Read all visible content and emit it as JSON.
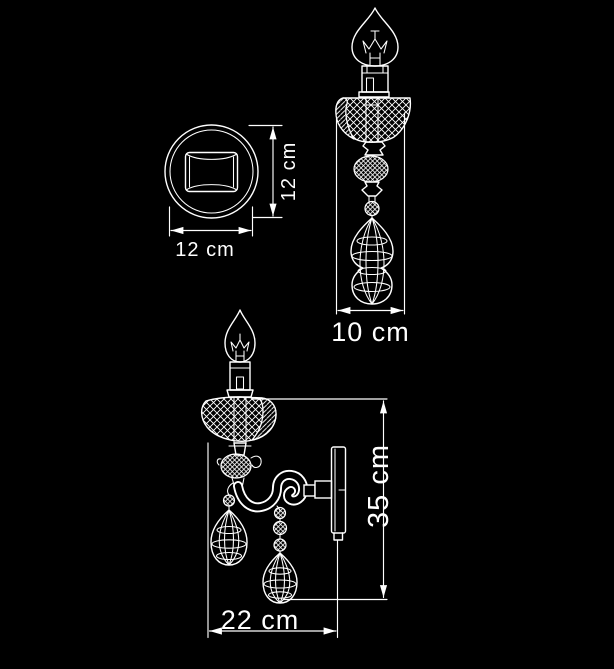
{
  "figure": {
    "background_color": "#000000",
    "line_color": "#ffffff"
  },
  "dimensions": {
    "plate_height": "12 cm",
    "plate_width": "12 cm",
    "depth": "10 cm",
    "height": "35 cm",
    "width": "22 cm"
  }
}
